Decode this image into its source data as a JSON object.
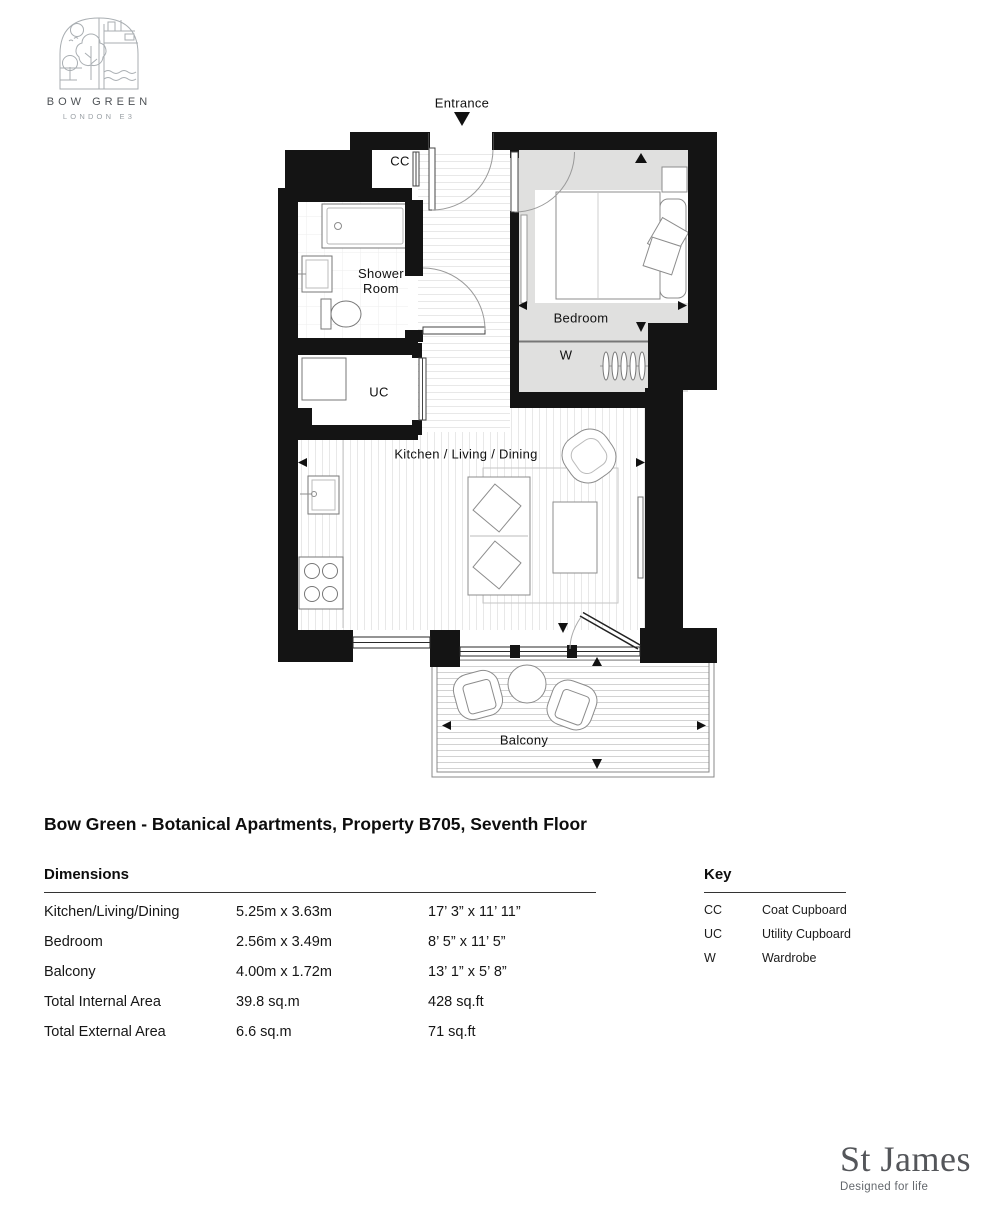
{
  "logo": {
    "name": "BOW GREEN",
    "location": "LONDON E3"
  },
  "plan": {
    "labels": {
      "entrance": "Entrance",
      "cc": "CC",
      "shower_room": "Shower Room",
      "uc": "UC",
      "bedroom": "Bedroom",
      "wardrobe": "W",
      "kitchen": "Kitchen / Living / Dining",
      "balcony": "Balcony"
    }
  },
  "title": "Bow Green - Botanical Apartments, Property B705, Seventh Floor",
  "dimensions": {
    "heading": "Dimensions",
    "rows": [
      {
        "room": "Kitchen/Living/Dining",
        "metric": "5.25m x 3.63m",
        "imperial": "17’ 3” x 11’ 11”"
      },
      {
        "room": "Bedroom",
        "metric": "2.56m x 3.49m",
        "imperial": "8’ 5” x 11’ 5”"
      },
      {
        "room": "Balcony",
        "metric": "4.00m x 1.72m",
        "imperial": "13’ 1” x 5’ 8”"
      },
      {
        "room": "Total Internal Area",
        "metric": "39.8 sq.m",
        "imperial": "428 sq.ft"
      },
      {
        "room": "Total External Area",
        "metric": "6.6 sq.m",
        "imperial": "71 sq.ft"
      }
    ]
  },
  "key": {
    "heading": "Key",
    "rows": [
      {
        "abbr": "CC",
        "label": "Coat Cupboard"
      },
      {
        "abbr": "UC",
        "label": "Utility Cupboard"
      },
      {
        "abbr": "W",
        "label": "Wardrobe"
      }
    ]
  },
  "brand": {
    "name": "St James",
    "tagline": "Designed for life"
  }
}
